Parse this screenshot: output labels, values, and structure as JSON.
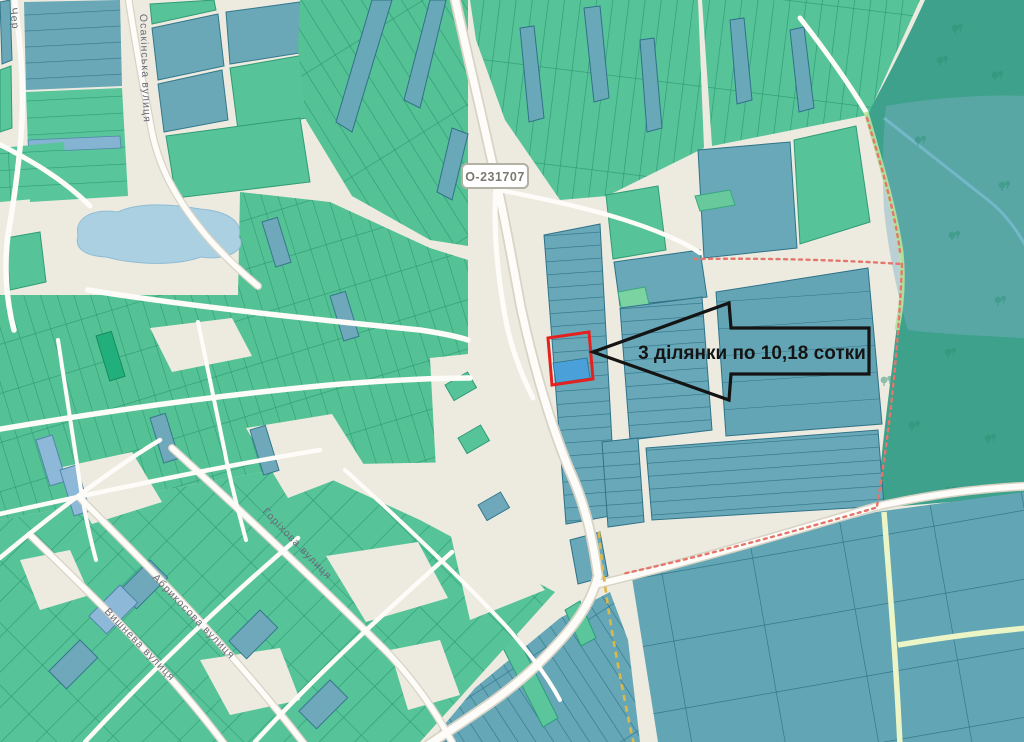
{
  "map": {
    "road_label": "О-231707",
    "annotation": {
      "text": "3 ділянки по 10,18 сотки"
    },
    "streets": {
      "partial_left": "Чер",
      "vertical": "Осакінська вулиця",
      "horikhova": "Горіхова вулиця",
      "abrykosova": "Абрикосова вулиця",
      "vyshneva": "Вишнева вулиця"
    },
    "colors": {
      "background": "#edebe0",
      "parcel_green": "#57c399",
      "parcel_green_border": "#2f9c77",
      "parcel_teal": "#68a8b8",
      "parcel_teal_border": "#2f7288",
      "parcel_blue": "#8db8d8",
      "highlight_blue": "#4aa0d8",
      "highlight_outline": "#e5211f",
      "water": "#abd0e2",
      "forest": "#3da18b",
      "road_fill": "#fdfcf8",
      "boundary_red": "#e4766b",
      "boundary_yellow": "#dcb84a",
      "annotation_color": "#141414"
    }
  }
}
